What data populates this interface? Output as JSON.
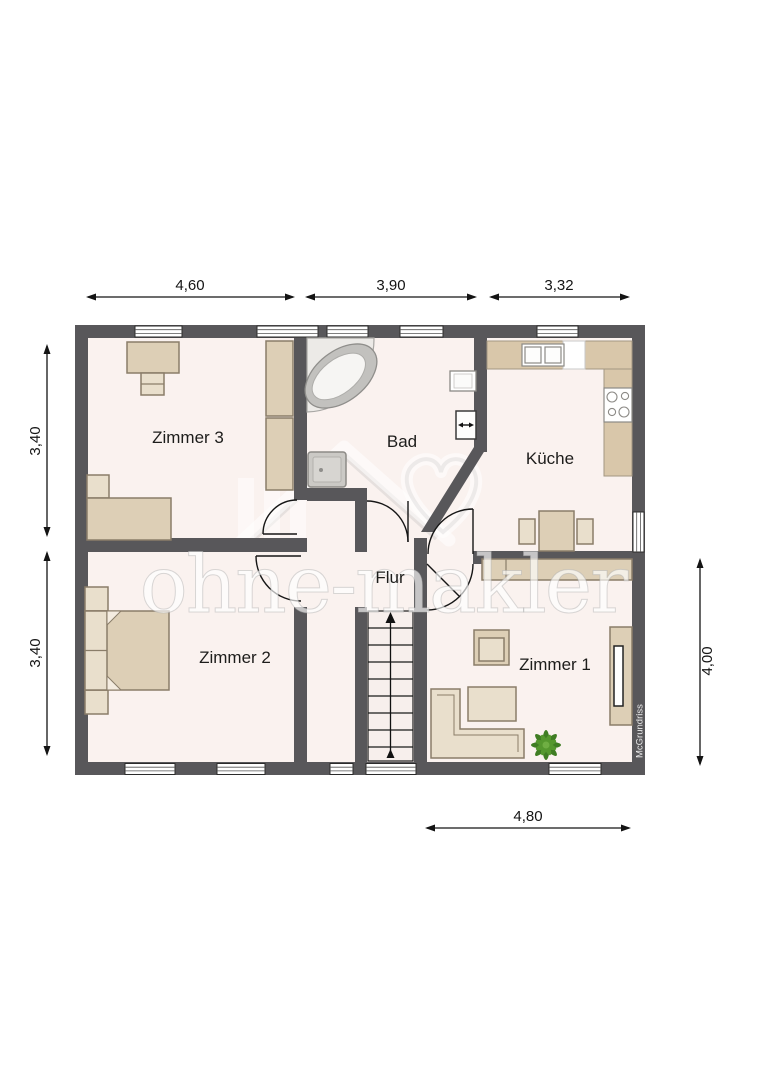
{
  "plan": {
    "watermark_text": "ohne-makler",
    "credit_text": "McGrundriss",
    "rooms": {
      "zimmer3": "Zimmer 3",
      "bad": "Bad",
      "kueche": "Küche",
      "zimmer2": "Zimmer 2",
      "zimmer1": "Zimmer 1",
      "flur": "Flur"
    },
    "dimensions": {
      "top": [
        "4,60",
        "3,90",
        "3,32"
      ],
      "left": [
        "3,40",
        "3,40"
      ],
      "right": [
        "4,00"
      ],
      "bottom": [
        "4,80"
      ]
    },
    "colors": {
      "wall": "#58575a",
      "floor": "#faf2ef",
      "furniture_fill": "#ddcfb6",
      "furniture_fill_light": "#e9dfcc",
      "furniture_border": "#8a7d69",
      "counter_fill": "#d9c7aa",
      "fixture_gray": "#cbc9c5",
      "plant_green": "#3f7d23",
      "dimension_color": "#141414",
      "watermark_color": "#ffffff"
    },
    "furniture_icons": [
      "bathtub-icon",
      "shower-icon",
      "washbasin-icon",
      "wc-icon",
      "kitchen-counter-icon",
      "kitchen-sink-icon",
      "stove-icon",
      "dining-table-icon",
      "chair-icon",
      "desk-icon",
      "desk-chair-icon",
      "wardrobe-icon",
      "single-bed-icon",
      "double-bed-icon",
      "nightstand-icon",
      "corner-sofa-icon",
      "armchair-icon",
      "coffee-table-icon",
      "plant-icon",
      "tv-lowboard-icon",
      "sideboard-icon",
      "stairs-icon",
      "window-icon",
      "door-icon"
    ]
  }
}
